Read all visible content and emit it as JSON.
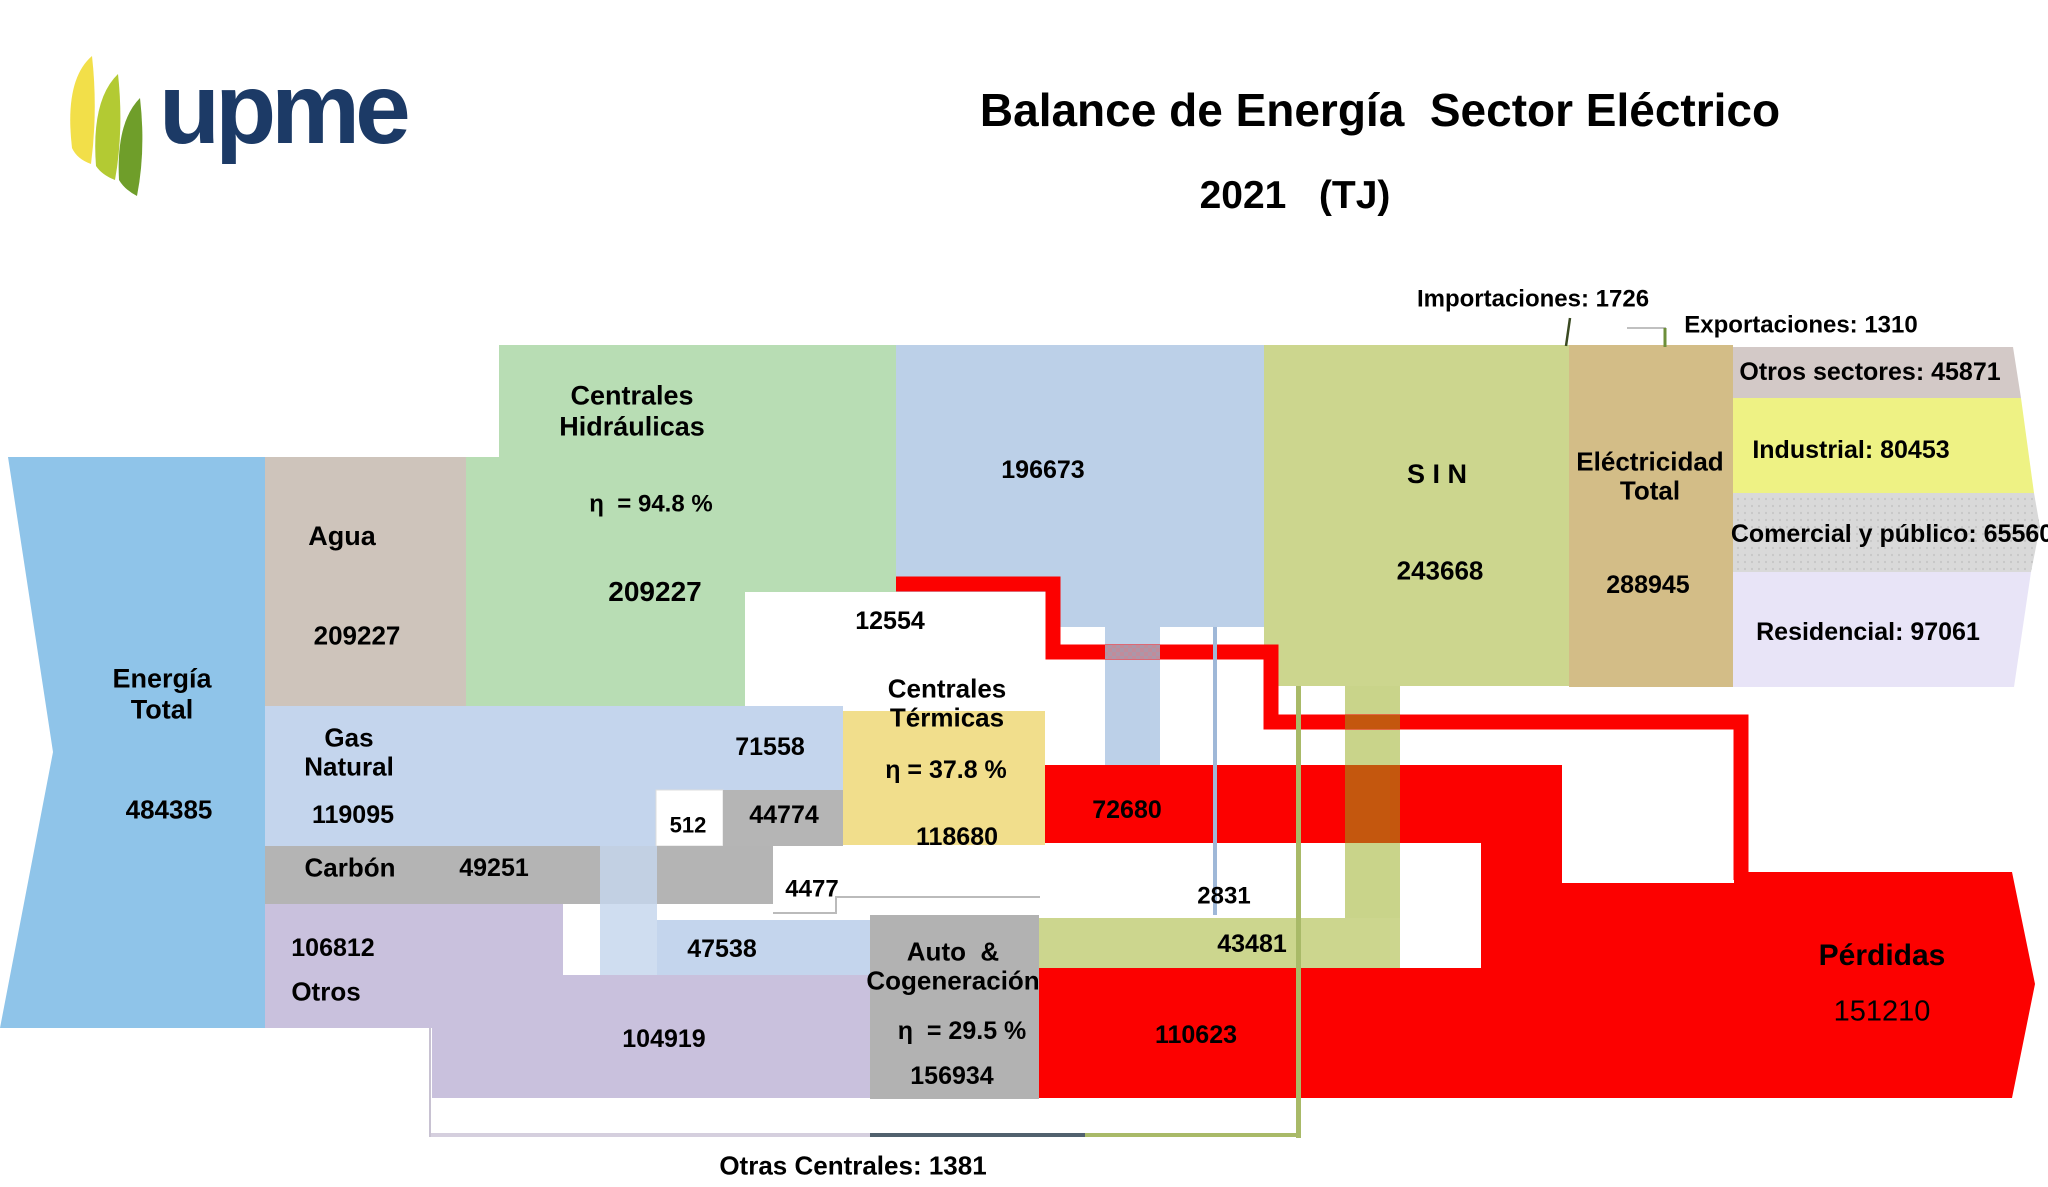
{
  "header": {
    "logo_text": "upme",
    "title": "Balance de Energía  Sector Eléctrico",
    "subtitle": "2021   (TJ)"
  },
  "annotations": {
    "importaciones": "Importaciones: 1726",
    "exportaciones": "Exportaciones: 1310",
    "otras_centrales": "Otras Centrales: 1381"
  },
  "nodes": {
    "energia_total": {
      "label": "Energía\nTotal",
      "value": "484385"
    },
    "agua": {
      "label": "Agua",
      "value": "209227"
    },
    "gas_natural": {
      "label": "Gas\nNatural",
      "value": "119095"
    },
    "carbon": {
      "label": "Carbón",
      "value": "49251"
    },
    "otros": {
      "label": "Otros",
      "value": "106812"
    },
    "centrales_hidraulicas": {
      "label": "Centrales\nHidráulicas",
      "eta": "η  = 94.8 %",
      "value": "209227"
    },
    "centrales_termicas": {
      "label": "Centrales\nTérmicas",
      "eta": "η = 37.8 %",
      "value": "118680"
    },
    "auto_cogeneracion": {
      "label": "Auto  &\nCogeneración",
      "eta": "η  = 29.5 %",
      "value": "156934"
    },
    "sin": {
      "label": "S I N",
      "value": "243668"
    },
    "electricidad_total": {
      "label": "Eléctricidad\nTotal",
      "value": "288945"
    },
    "perdidas": {
      "label": "Pérdidas",
      "value": "151210"
    }
  },
  "flows": {
    "hidro_to_sin": "196673",
    "hidro_perdidas": "12554",
    "gas_to_termicas": "71558",
    "gas_small": "512",
    "carbon_to_termicas": "44774",
    "carbon_perdidas": "4477",
    "termicas_to_sin": "2831",
    "termicas_perdidas": "72680",
    "gas_to_auto": "47538",
    "otros_to_auto": "104919",
    "auto_to_sin": "43481",
    "auto_perdidas": "110623"
  },
  "sectors": [
    {
      "label": "Otros sectores: 45871"
    },
    {
      "label": "Industrial: 80453"
    },
    {
      "label": "Comercial y público: 65560"
    },
    {
      "label": "Residencial: 97061"
    }
  ],
  "colors": {
    "energia_total": "#8fc4e9",
    "agua": "#cec4bb",
    "hidraulicas": "#b8ddb4",
    "flujo_azul": "#bcd0e8",
    "gas_natural": "#c4d5ed",
    "carbon": "#b4b4b4",
    "otros": "#c9c1dd",
    "termicas": "#f1de8c",
    "auto_cogeneracion": "#b2b2b2",
    "sin": "#ccd68e",
    "electricidad": "#d3bd87",
    "perdidas": "#fc0100",
    "cruce_naranja": "#c4570e",
    "otros_sectores": "#d3c9c7",
    "industrial": "#eef284",
    "comercial": "#d7d7d7",
    "residencial": "#e8e4f7",
    "logo_navy": "#1c3a66"
  },
  "chart_data": {
    "type": "sankey",
    "title": "Balance de Energía  Sector Eléctrico",
    "year": "2021",
    "unit": "TJ",
    "nodes": [
      {
        "name": "Energía Total",
        "value": 484385
      },
      {
        "name": "Agua",
        "value": 209227
      },
      {
        "name": "Gas Natural",
        "value": 119095
      },
      {
        "name": "Carbón",
        "value": 49251
      },
      {
        "name": "Otros",
        "value": 106812
      },
      {
        "name": "Centrales Hidráulicas",
        "value": 209227,
        "eficiencia_pct": 94.8
      },
      {
        "name": "Centrales Térmicas",
        "value": 118680,
        "eficiencia_pct": 37.8
      },
      {
        "name": "Auto & Cogeneración",
        "value": 156934,
        "eficiencia_pct": 29.5
      },
      {
        "name": "S I N",
        "value": 243668
      },
      {
        "name": "Eléctricidad Total",
        "value": 288945
      },
      {
        "name": "Pérdidas",
        "value": 151210
      }
    ],
    "links": [
      {
        "source": "Agua",
        "target": "Centrales Hidráulicas",
        "value": 209227
      },
      {
        "source": "Centrales Hidráulicas",
        "target": "S I N",
        "value": 196673
      },
      {
        "source": "Centrales Hidráulicas",
        "target": "Pérdidas",
        "value": 12554
      },
      {
        "source": "Gas Natural",
        "target": "Centrales Térmicas",
        "value": 71558
      },
      {
        "source": "Gas Natural",
        "target": "Auto & Cogeneración",
        "value": 47538
      },
      {
        "source": "Gas Natural",
        "target": "Otros flujos",
        "value": 512
      },
      {
        "source": "Carbón",
        "target": "Centrales Térmicas",
        "value": 44774
      },
      {
        "source": "Carbón",
        "target": "Pérdidas",
        "value": 4477
      },
      {
        "source": "Centrales Térmicas",
        "target": "S I N",
        "value": 2831
      },
      {
        "source": "Centrales Térmicas",
        "target": "Pérdidas",
        "value": 72680
      },
      {
        "source": "Otros",
        "target": "Auto & Cogeneración",
        "value": 104919
      },
      {
        "source": "Auto & Cogeneración",
        "target": "S I N",
        "value": 43481
      },
      {
        "source": "Auto & Cogeneración",
        "target": "Pérdidas",
        "value": 110623
      },
      {
        "source": "Otras Centrales",
        "target": "S I N",
        "value": 1381
      },
      {
        "source": "Importaciones",
        "target": "S I N",
        "value": 1726
      },
      {
        "source": "S I N",
        "target": "Exportaciones",
        "value": 1310
      },
      {
        "source": "Eléctricidad Total",
        "target": "Otros sectores",
        "value": 45871
      },
      {
        "source": "Eléctricidad Total",
        "target": "Industrial",
        "value": 80453
      },
      {
        "source": "Eléctricidad Total",
        "target": "Comercial y público",
        "value": 65560
      },
      {
        "source": "Eléctricidad Total",
        "target": "Residencial",
        "value": 97061
      }
    ]
  }
}
